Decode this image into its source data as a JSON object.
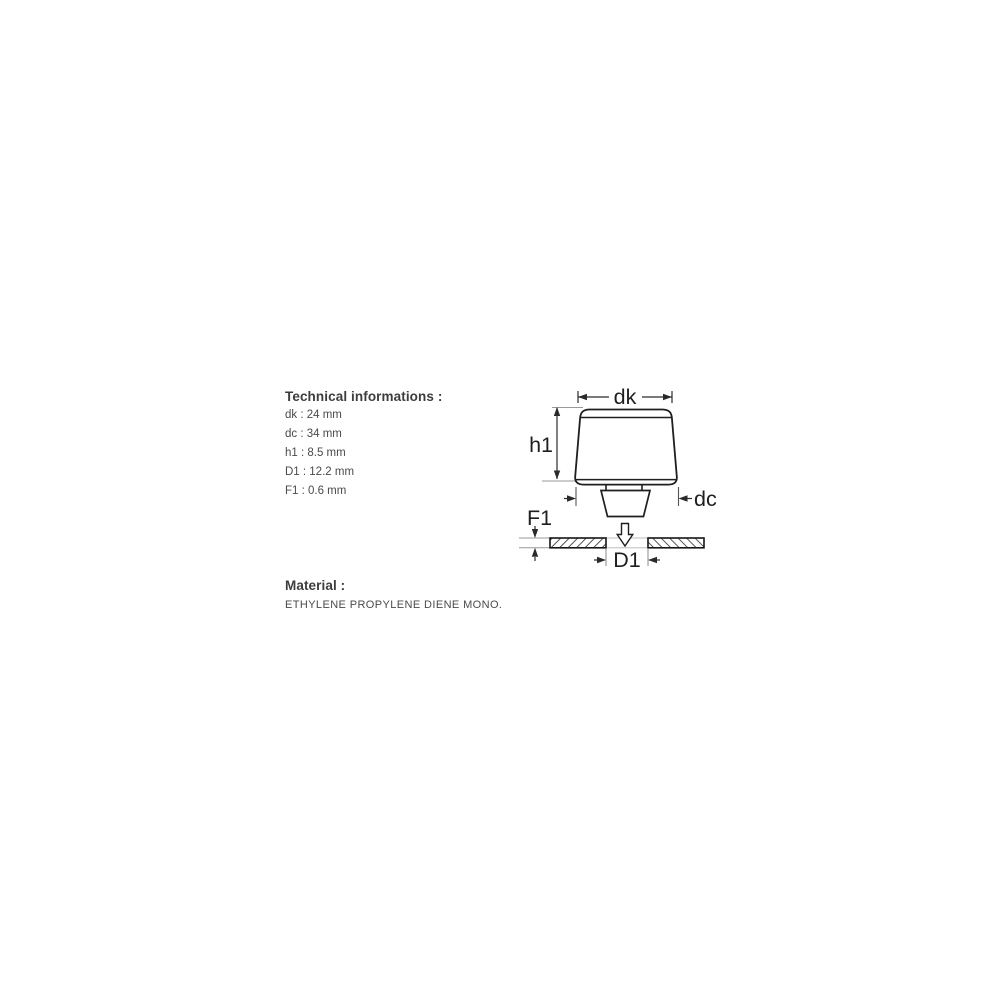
{
  "page": {
    "background": "#ffffff"
  },
  "tech_info": {
    "heading": "Technical informations :",
    "items": [
      "dk : 24 mm",
      "dc : 34 mm",
      "h1 : 8.5 mm",
      "D1 : 12.2 mm",
      "F1 : 0.6 mm"
    ]
  },
  "material": {
    "heading": "Material :",
    "value": "ETHYLENE PROPYLENE DIENE MONO."
  },
  "diagram": {
    "labels": {
      "top_diameter": "dk",
      "height": "h1",
      "base_diameter": "dc",
      "panel_thickness": "F1",
      "hole_diameter": "D1"
    },
    "colors": {
      "outline": "#1f1f1f",
      "dimension": "#2a2a2a",
      "extension": "#999999",
      "hatch": "#555555",
      "gap_line": "#bdbdbd"
    }
  }
}
